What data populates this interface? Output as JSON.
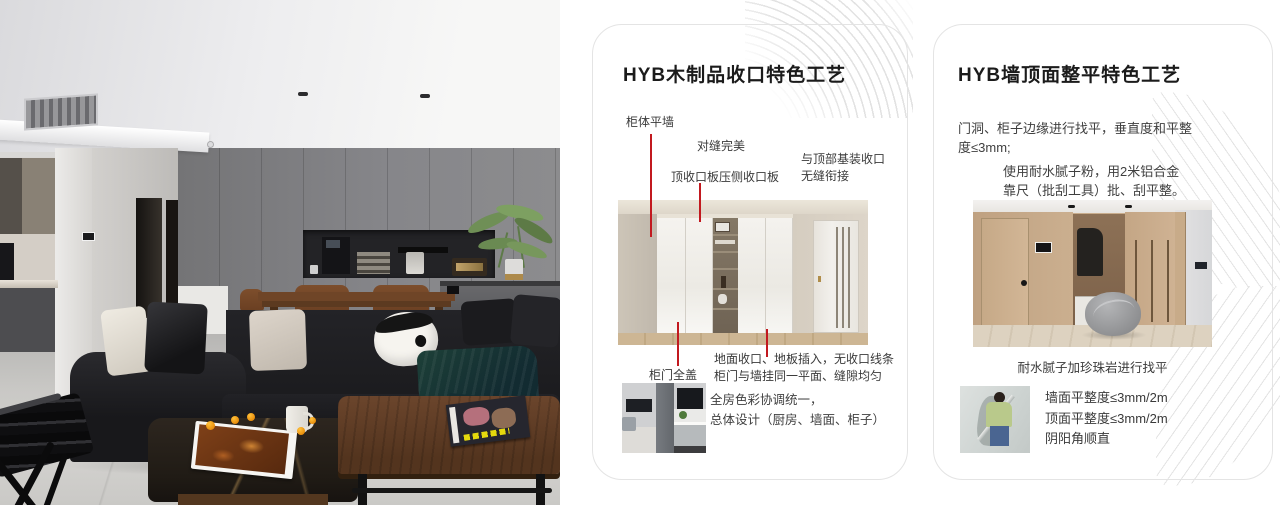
{
  "colors": {
    "accent_red": "#c2191f",
    "card_border": "#e4e4e4",
    "title_text": "#1b1b1b",
    "body_text": "#3f3f3f"
  },
  "card1": {
    "title": "HYB木制品收口特色工艺",
    "callout_cabinet_wall": "柜体平墙",
    "callout_seam": "对缝完美",
    "callout_top_panel": "顶收口板压侧收口板",
    "callout_ceiling_1": "与顶部基装收口",
    "callout_ceiling_2": "无缝衔接",
    "callout_door": "柜门全盖",
    "callout_floor_1": "地面收口、地板插入，无收口线条",
    "callout_floor_2": "柜门与墙挂同一平面、缝隙均匀",
    "summary_1": "全房色彩协调统一，",
    "summary_2": "总体设计（厨房、墙面、柜子）"
  },
  "card2": {
    "title": "HYB墙顶面整平特色工艺",
    "para1_1": "门洞、柜子边缘进行找平，垂直度和平整",
    "para1_2": "度≤3mm;",
    "para2_1": "使用耐水腻子粉，用2米铝合金",
    "para2_2": "靠尺（批刮工具）批、刮平整。",
    "caption": "耐水腻子加珍珠岩进行找平",
    "spec_1": "墙面平整度≤3mm/2m",
    "spec_2": "顶面平整度≤3mm/2m",
    "spec_3": "阴阳角顺直"
  }
}
